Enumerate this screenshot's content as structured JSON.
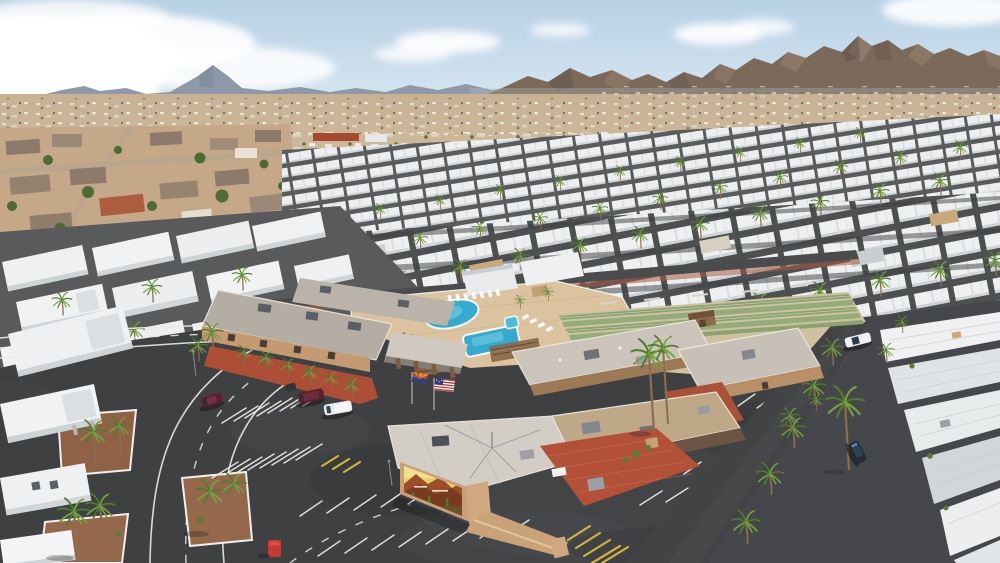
{
  "meta": {
    "title": "Aerial drone photo of a desert mobile home park community",
    "domain": "Natural-Image",
    "width": 1000,
    "height": 563
  },
  "scene": {
    "description": "Midday aerial view of a large 55+ style mobile home park in the Arizona desert. A central clubhouse campus with two blue swimming pools, a spa, shuffleboard courts, ramadas and a mural-painted hall is surrounded by black asphalt parking lots and palm-lined streets. Long diagonal rows of white mobile homes stretch toward a desert valley town, with brown mountain ranges and a pale blue sky with clouds on the horizon.",
    "sky": {
      "condition": "partly cloudy",
      "cloud_sides": [
        "large cloud bank left",
        "small clouds center and right"
      ]
    },
    "terrain": [
      "brown mountain range right",
      "blue-gray distant peaks left",
      "tan desert valley with scattered town buildings",
      "open dirt field on right"
    ],
    "campus": {
      "buildings": [
        "L-shaped clubhouse",
        "recreation hall",
        "east hall with dark roof wing",
        "main hall with desert mural",
        "small far-right hall",
        "brown storage shed"
      ],
      "amenities": [
        "kidney-shaped pool",
        "rectangular pool",
        "spa",
        "lounge chairs",
        "fire-pit chair circle",
        "shuffleboard courts",
        "red brick courtyard",
        "wood ramadas"
      ],
      "flags": [
        "United States flag",
        "Arizona state flag"
      ],
      "mural": "desert scene with mountains, golden sky and cacti (lettering illegible)"
    },
    "vehicles": [
      "maroon sedan",
      "maroon SUV",
      "white van",
      "golf cart",
      "white pickup on right road",
      "dark SUV on right road",
      "red portable toilet cabin"
    ],
    "vegetation": [
      "several dozen palm trees along streets and buildings",
      "desert shrubs",
      "gravel planting islands with white curbs"
    ],
    "roads": [
      "curving street lower left with white edge lines and dashed center line",
      "diagonal street on right lined with palms",
      "parking stalls with white stripes",
      "yellow hatched no-parking zones"
    ]
  },
  "palette": {
    "skyTop": "#b7d1e5",
    "skyBot": "#dbe9f2",
    "cloud": "#ffffff",
    "mtnFar": "#8d99a8",
    "mtnFarShade": "#7c8898",
    "mtnNear": "#7b695a",
    "mtnNearDark": "#63544a",
    "mtnNearLight": "#97826d",
    "valley": "#c9b293",
    "valleyNear": "#cfbc9f",
    "field": "#c29a72",
    "suburbGround": "#c4a888",
    "roofBrown": "#8d7a6a",
    "roofTile": "#ad5d3d",
    "treeGreen": "#4e6b35",
    "street": "#4a4b4d",
    "asphalt": "#3f4042",
    "asphaltLight": "#56575b",
    "lineWhite": "#eceae6",
    "lineYellow": "#d9b93e",
    "homeWhite": "#edeff1",
    "homeShade": "#cdd2d5",
    "homeGap": "#515254",
    "deck": "#dcc3a0",
    "gravelRed": "#ad4f36",
    "gravelBrown": "#95684c",
    "roofGray": "#c8c2b9",
    "roofGray2": "#d2cdc5",
    "wallTan": "#c49a72",
    "wallTanDark": "#6b5443",
    "wallLight": "#cfa87f",
    "poolBlue": "#36a9cf",
    "poolLight": "#7fd2e6",
    "spaBlue": "#49bcd9",
    "courtGreen": "#8aa371",
    "courtTan": "#cfc0a0",
    "brick": "#b25138",
    "brickLight": "#c97757",
    "palmGreen": "#4e7c30",
    "palmLight": "#74a23e",
    "trunk": "#8a6f4e",
    "flagRed": "#b03a2e",
    "flagBlue": "#303f85",
    "flagYellow": "#d79a2b",
    "flagStar": "#b5651d",
    "carMaroon": "#5e1f2e",
    "carWhite": "#eef0f2",
    "carDark": "#222d36",
    "portaRed": "#c23b35"
  }
}
